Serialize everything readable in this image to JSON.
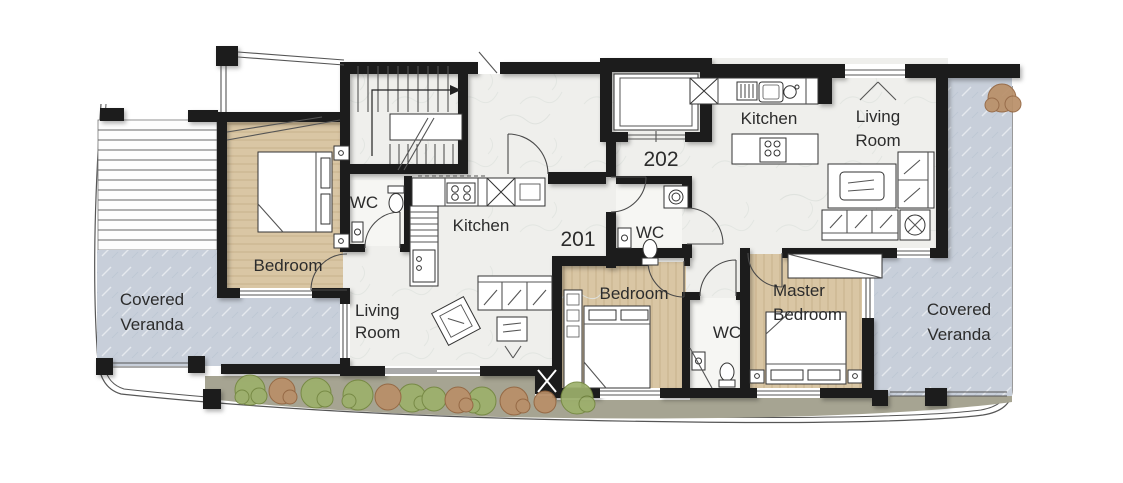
{
  "plan_type": "floor-plan",
  "units": {
    "u201": {
      "number": "201",
      "rooms": {
        "bedroom": "Bedroom",
        "wc": "WC",
        "kitchen": "Kitchen",
        "living": {
          "name": "Living Room",
          "lines": [
            "Living",
            "Room"
          ]
        },
        "veranda": {
          "name": "Covered Veranda",
          "lines": [
            "Covered",
            "Veranda"
          ]
        }
      }
    },
    "u202": {
      "number": "202",
      "rooms": {
        "kitchen": "Kitchen",
        "living": {
          "name": "Living Room",
          "lines": [
            "Living",
            "Room"
          ]
        },
        "wc_entry": "WC",
        "wc_inner": "WC",
        "bedroom": "Bedroom",
        "master": {
          "name": "Master Bedroom",
          "lines": [
            "Master",
            "Bedroom"
          ]
        },
        "veranda": {
          "name": "Covered Veranda",
          "lines": [
            "Covered",
            "Veranda"
          ]
        }
      }
    }
  },
  "colors": {
    "wall": "#1c1c1c",
    "label": "#2c2c2c",
    "marble": "#efefec",
    "marbleVein": "#dfe2de",
    "wood": "#d9c6a4",
    "woodLine": "#c2ab84",
    "veranda": "#c8cfda",
    "verandaVein": "#dde3ec",
    "walkway": "#a6a492",
    "bushGreen": "#9db06c",
    "bushBrown": "#b98f68"
  }
}
